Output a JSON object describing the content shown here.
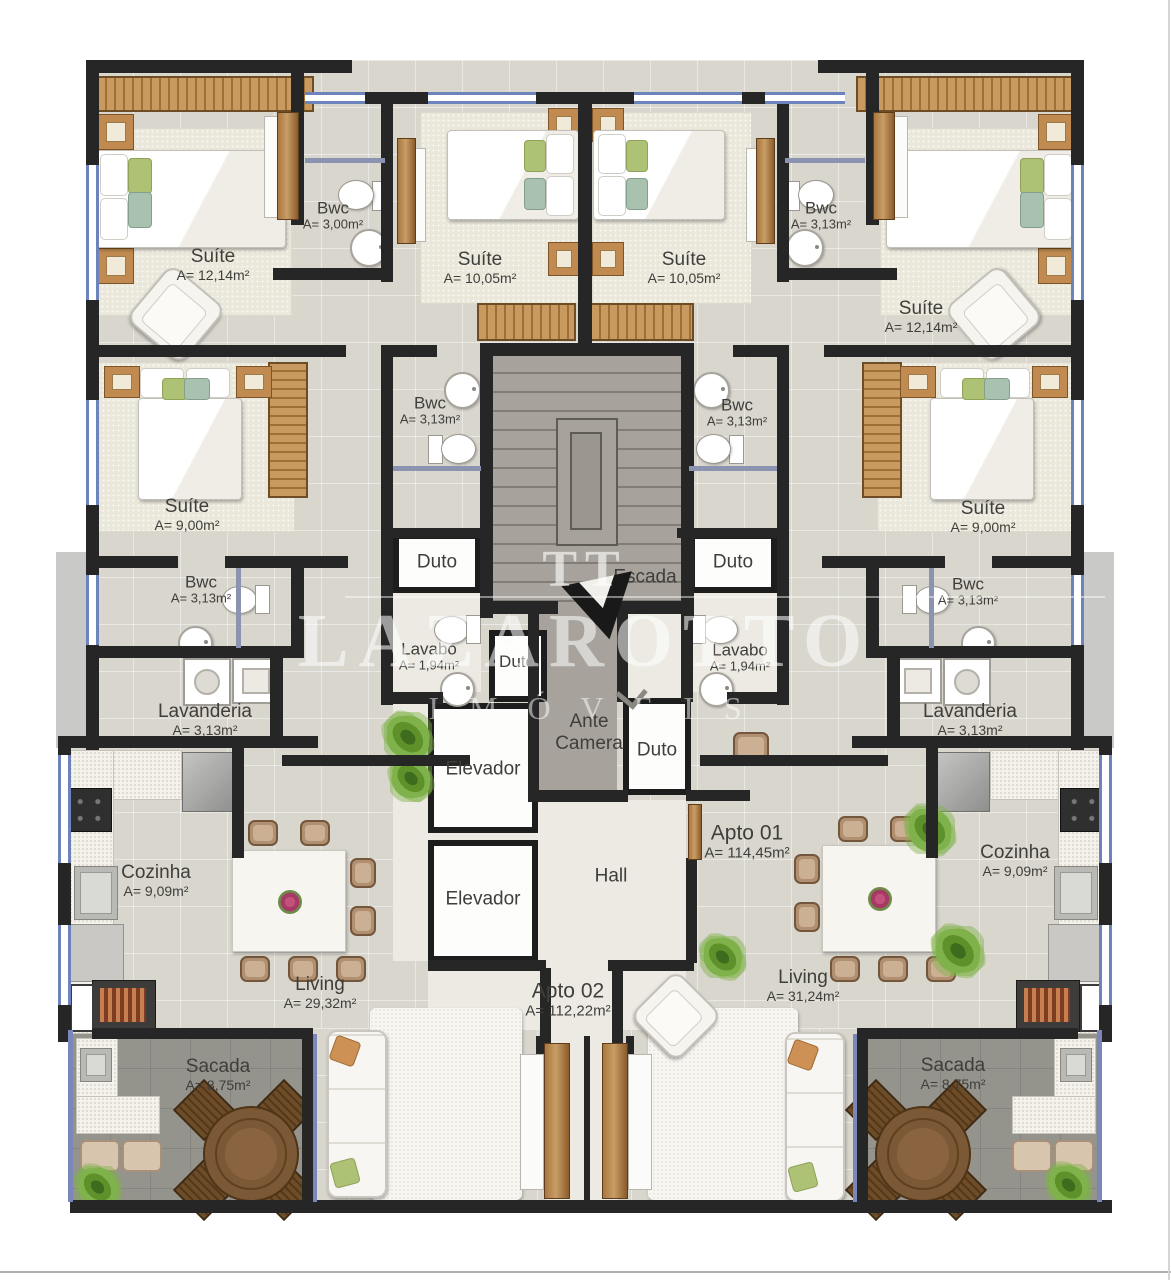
{
  "watermark": {
    "logo": "TT",
    "title": "LAZAROTTO",
    "subtitle": "IMÓVEIS"
  },
  "rooms": [
    {
      "id": "suite-tl",
      "line1": "Suíte",
      "line2": "A= 12,14m²",
      "x": 213,
      "y": 265
    },
    {
      "id": "bwc-tl",
      "line1": "Bwc",
      "line2": "A= 3,00m²",
      "x": 333,
      "y": 216,
      "cls": "sm"
    },
    {
      "id": "suite-tcl",
      "line1": "Suíte",
      "line2": "A= 10,05m²",
      "x": 480,
      "y": 268
    },
    {
      "id": "suite-tcr",
      "line1": "Suíte",
      "line2": "A= 10,05m²",
      "x": 684,
      "y": 268
    },
    {
      "id": "bwc-tr",
      "line1": "Bwc",
      "line2": "A= 3,13m²",
      "x": 821,
      "y": 216,
      "cls": "sm"
    },
    {
      "id": "suite-tr",
      "line1": "Suíte",
      "line2": "A= 12,14m²",
      "x": 921,
      "y": 317
    },
    {
      "id": "suite-ml",
      "line1": "Suíte",
      "line2": "A= 9,00m²",
      "x": 187,
      "y": 515
    },
    {
      "id": "suite-mr",
      "line1": "Suíte",
      "line2": "A= 9,00m²",
      "x": 983,
      "y": 517
    },
    {
      "id": "bwc-ml-inner",
      "line1": "Bwc",
      "line2": "A= 3,13m²",
      "x": 430,
      "y": 411,
      "cls": "sm"
    },
    {
      "id": "bwc-mr-inner",
      "line1": "Bwc",
      "line2": "A= 3,13m²",
      "x": 737,
      "y": 413,
      "cls": "sm"
    },
    {
      "id": "escada",
      "line1": "Escada",
      "x": 645,
      "y": 578
    },
    {
      "id": "duto-l",
      "line1": "Duto",
      "x": 437,
      "y": 563
    },
    {
      "id": "duto-r",
      "line1": "Duto",
      "x": 733,
      "y": 563
    },
    {
      "id": "lavabo-l",
      "line1": "Lavabo",
      "line2": "A= 1,94m²",
      "x": 429,
      "y": 657,
      "cls": "sm"
    },
    {
      "id": "lavabo-r",
      "line1": "Lavabo",
      "line2": "A= 1,94m²",
      "x": 740,
      "y": 658,
      "cls": "sm"
    },
    {
      "id": "duto-bl",
      "line1": "Duto",
      "x": 517,
      "y": 662,
      "cls": "sm"
    },
    {
      "id": "bwc-ml",
      "line1": "Bwc",
      "line2": "A= 3,13m²",
      "x": 201,
      "y": 590,
      "cls": "sm"
    },
    {
      "id": "bwc-mr",
      "line1": "Bwc",
      "line2": "A= 3,13m²",
      "x": 968,
      "y": 592,
      "cls": "sm"
    },
    {
      "id": "lavanderia-l",
      "line1": "Lavanderia",
      "line2": "A= 3,13m²",
      "x": 205,
      "y": 720
    },
    {
      "id": "lavanderia-r",
      "line1": "Lavanderia",
      "line2": "A= 3,13m²",
      "x": 970,
      "y": 720
    },
    {
      "id": "ante-camera",
      "line1": "Ante",
      "line2": "Camera",
      "x": 589,
      "y": 733,
      "cls": "two"
    },
    {
      "id": "duto-cr",
      "line1": "Duto",
      "x": 657,
      "y": 751
    },
    {
      "id": "elevador-1",
      "line1": "Elevador",
      "x": 483,
      "y": 770
    },
    {
      "id": "elevador-2",
      "line1": "Elevador",
      "x": 483,
      "y": 900
    },
    {
      "id": "hall",
      "line1": "Hall",
      "x": 611,
      "y": 877
    },
    {
      "id": "apto-01",
      "line1": "Apto 01",
      "line2": "A= 114,45m²",
      "x": 747,
      "y": 842,
      "cls": "big"
    },
    {
      "id": "cozinha-l",
      "line1": "Cozinha",
      "line2": "A= 9,09m²",
      "x": 156,
      "y": 881
    },
    {
      "id": "cozinha-r",
      "line1": "Cozinha",
      "line2": "A= 9,09m²",
      "x": 1015,
      "y": 861
    },
    {
      "id": "living-l",
      "line1": "Living",
      "line2": "A= 29,32m²",
      "x": 320,
      "y": 993
    },
    {
      "id": "living-r",
      "line1": "Living",
      "line2": "A= 31,24m²",
      "x": 803,
      "y": 986
    },
    {
      "id": "apto-02",
      "line1": "Apto 02",
      "line2": "A= 112,22m²",
      "x": 568,
      "y": 1000,
      "cls": "big"
    },
    {
      "id": "sacada-l",
      "line1": "Sacada",
      "line2": "A= 8,75m²",
      "x": 218,
      "y": 1075
    },
    {
      "id": "sacada-r",
      "line1": "Sacada",
      "line2": "A= 8,75m²",
      "x": 953,
      "y": 1074
    }
  ]
}
